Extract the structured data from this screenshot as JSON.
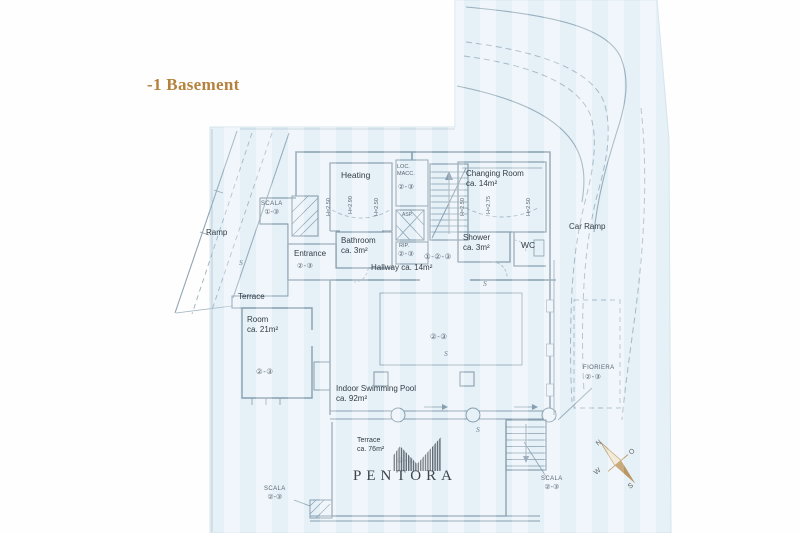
{
  "title": "-1 Basement",
  "brand": {
    "name": "PENTORA"
  },
  "rooms": {
    "heating": {
      "label": "Heating"
    },
    "loc_macc": {
      "line1": "LOC.",
      "line2": "MACC.",
      "marker": "②-③"
    },
    "changing": {
      "label": "Changing Room",
      "area": "ca. 14m²"
    },
    "bathroom": {
      "label": "Bathroom",
      "area": "ca. 3m²"
    },
    "shower": {
      "label": "Shower",
      "area": "ca. 3m²"
    },
    "wc": {
      "label": "WC"
    },
    "entrance": {
      "label": "Entrance",
      "marker": "②-③"
    },
    "hallway": {
      "label": "Hallway ca. 14m²",
      "marker": "①-②-③"
    },
    "room": {
      "label": "Room",
      "area": "ca. 21m²",
      "marker": "②-③"
    },
    "pool": {
      "label": "Indoor Swimming Pool",
      "area": "ca. 92m²",
      "marker": "②-③"
    },
    "terrace_upper": {
      "label": "Terrace"
    },
    "terrace_lower": {
      "label": "Terrace",
      "area": "ca. 76m²",
      "marker": "②-③"
    },
    "ramp": {
      "label": "Ramp"
    },
    "car_ramp": {
      "label": "Car Ramp"
    },
    "rip": {
      "label": "RIP.",
      "marker": "②-③"
    },
    "asp": {
      "label": "ASP."
    },
    "fioriera": {
      "label": "FIORIERA",
      "marker": "②-③"
    }
  },
  "stairs": {
    "scala_nw": {
      "label": "SCALA",
      "marker": "①-③"
    },
    "scala_sw": {
      "label": "SCALA",
      "marker": "②-③"
    },
    "scala_se": {
      "label": "SCALA",
      "marker": "②-③"
    }
  },
  "heights": {
    "heating_left": "H=2.50",
    "heating_mid": "H=2.90",
    "heating_right": "H=2.50",
    "changing_left": "H=2.50",
    "changing_mid": "H=2.75",
    "changing_right": "H=2.50"
  },
  "compass": {
    "n": "N",
    "e": "O",
    "w": "W",
    "s": "S"
  },
  "section_marker": "S",
  "colors": {
    "accent_gold": "#b5823e",
    "paper": "#eaf3f9",
    "plan_line": "#7a92a2",
    "dash_line": "#9db1bd",
    "logo_ink": "#4d545b",
    "compass_gold": "#b78c47"
  }
}
